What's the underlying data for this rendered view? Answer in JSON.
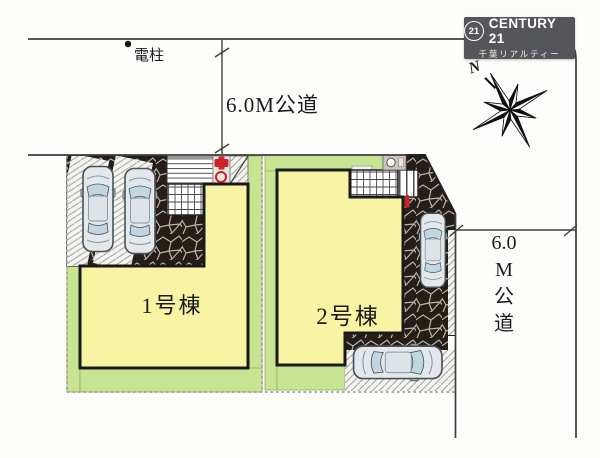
{
  "logo": {
    "badge": "21",
    "brand": "CENTURY 21",
    "subtitle": "千葉リアルティー"
  },
  "annotations": {
    "utility_pole": "電柱",
    "top_road": "6.0M公道",
    "right_road": [
      "6.0",
      "M",
      "公",
      "道"
    ],
    "north": "N"
  },
  "buildings": [
    {
      "label": "1号棟"
    },
    {
      "label": "2号棟"
    }
  ],
  "site": {
    "num_parked_cars": 4,
    "road_width_top": "6.0M",
    "road_width_right": "6.0M"
  },
  "colors": {
    "building_fill": "#f8f4a4",
    "lawn": "#c6e491",
    "lawn_edge": "#93ad62",
    "paving": "#241d18",
    "joint": "#bdb3a5",
    "hatch_bg": "#f4f4f1",
    "hatch_line": "#a5a5a0",
    "line": "#3e3e3e",
    "boundary": "#a09f95",
    "logo_bg": "#55565a",
    "red": "#cc2128"
  }
}
